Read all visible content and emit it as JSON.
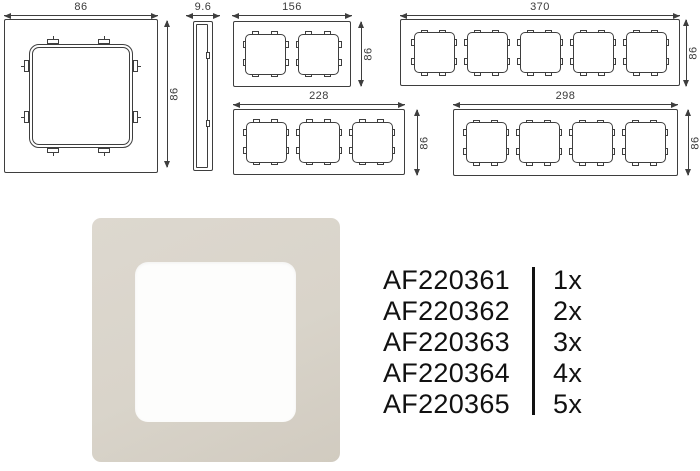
{
  "colors": {
    "background": "#ffffff",
    "line": "#3e3e3e",
    "dim_text": "#3a3a3a",
    "part_text": "#111111",
    "divider": "#111111",
    "photo_frame_light": "#ddd8cf",
    "photo_frame_mid": "#d9d4ca",
    "photo_frame_dark": "#d1cbc0",
    "photo_window": "#fdfdfc"
  },
  "drawings": {
    "front_single": {
      "width_label": "86",
      "height_label": "86",
      "gangs": 1
    },
    "side_profile": {
      "width_label": "9.6"
    },
    "frame_2gang": {
      "width_label": "156",
      "height_label": "86",
      "gangs": 2
    },
    "frame_5gang": {
      "width_label": "370",
      "height_label": "86",
      "gangs": 5
    },
    "frame_3gang": {
      "width_label": "228",
      "height_label": "86",
      "gangs": 3
    },
    "frame_4gang": {
      "width_label": "298",
      "height_label": "86",
      "gangs": 4
    }
  },
  "parts": {
    "rows": [
      {
        "sku": "AF220361",
        "qty": "1x"
      },
      {
        "sku": "AF220362",
        "qty": "2x"
      },
      {
        "sku": "AF220363",
        "qty": "3x"
      },
      {
        "sku": "AF220364",
        "qty": "4x"
      },
      {
        "sku": "AF220365",
        "qty": "5x"
      }
    ]
  }
}
